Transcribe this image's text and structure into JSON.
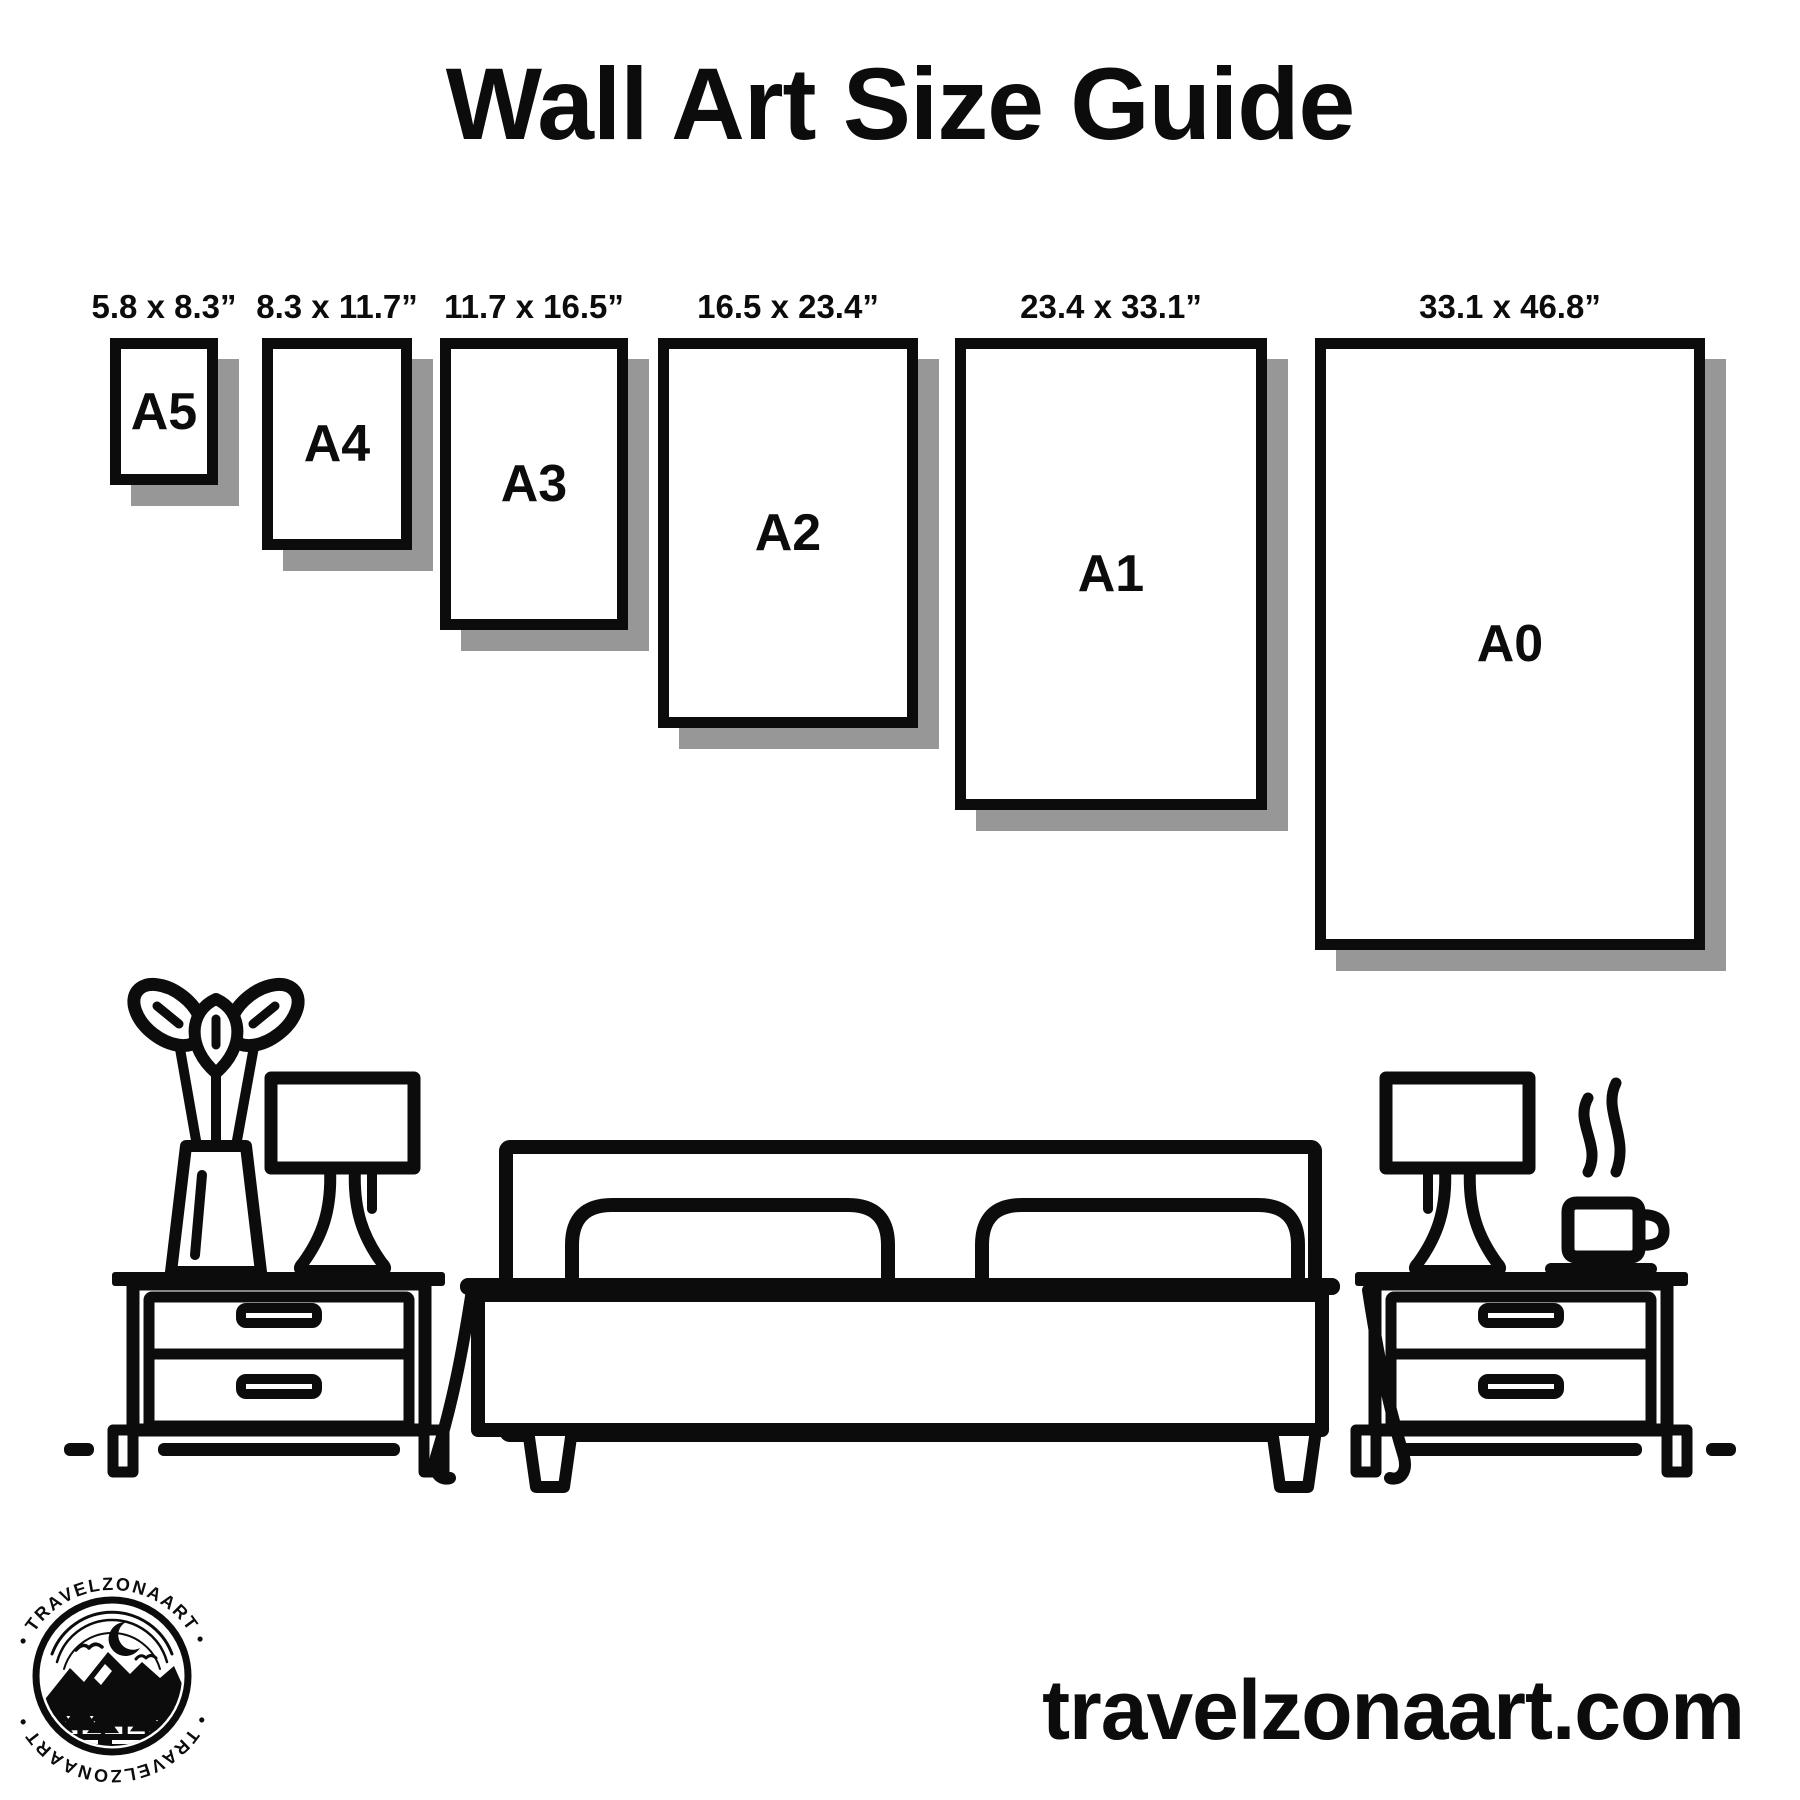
{
  "header": {
    "title": "Wall Art Size Guide"
  },
  "sizes": [
    {
      "code": "A5",
      "inches": "5.8 x 8.3”"
    },
    {
      "code": "A4",
      "inches": "8.3 x 11.7”"
    },
    {
      "code": "A3",
      "inches": "11.7 x 16.5”"
    },
    {
      "code": "A2",
      "inches": "16.5 x 23.4”"
    },
    {
      "code": "A1",
      "inches": "23.4 x 33.1”"
    },
    {
      "code": "A0",
      "inches": "33.1 x 46.8”"
    }
  ],
  "scene": {
    "icons": [
      "plant-vase-icon",
      "table-lamp-icon",
      "nightstand-icon",
      "bed-icon",
      "coffee-cup-icon",
      "steam-icon",
      "floor-line"
    ]
  },
  "logo": {
    "arc_top": "• TRAVELZONAART •",
    "arc_bottom": "• TRAVELZONAART •"
  },
  "footer": {
    "website": "travelzonaart.com"
  },
  "colors": {
    "ink": "#0c0c0c",
    "shadow": "#979797",
    "background": "#ffffff"
  }
}
